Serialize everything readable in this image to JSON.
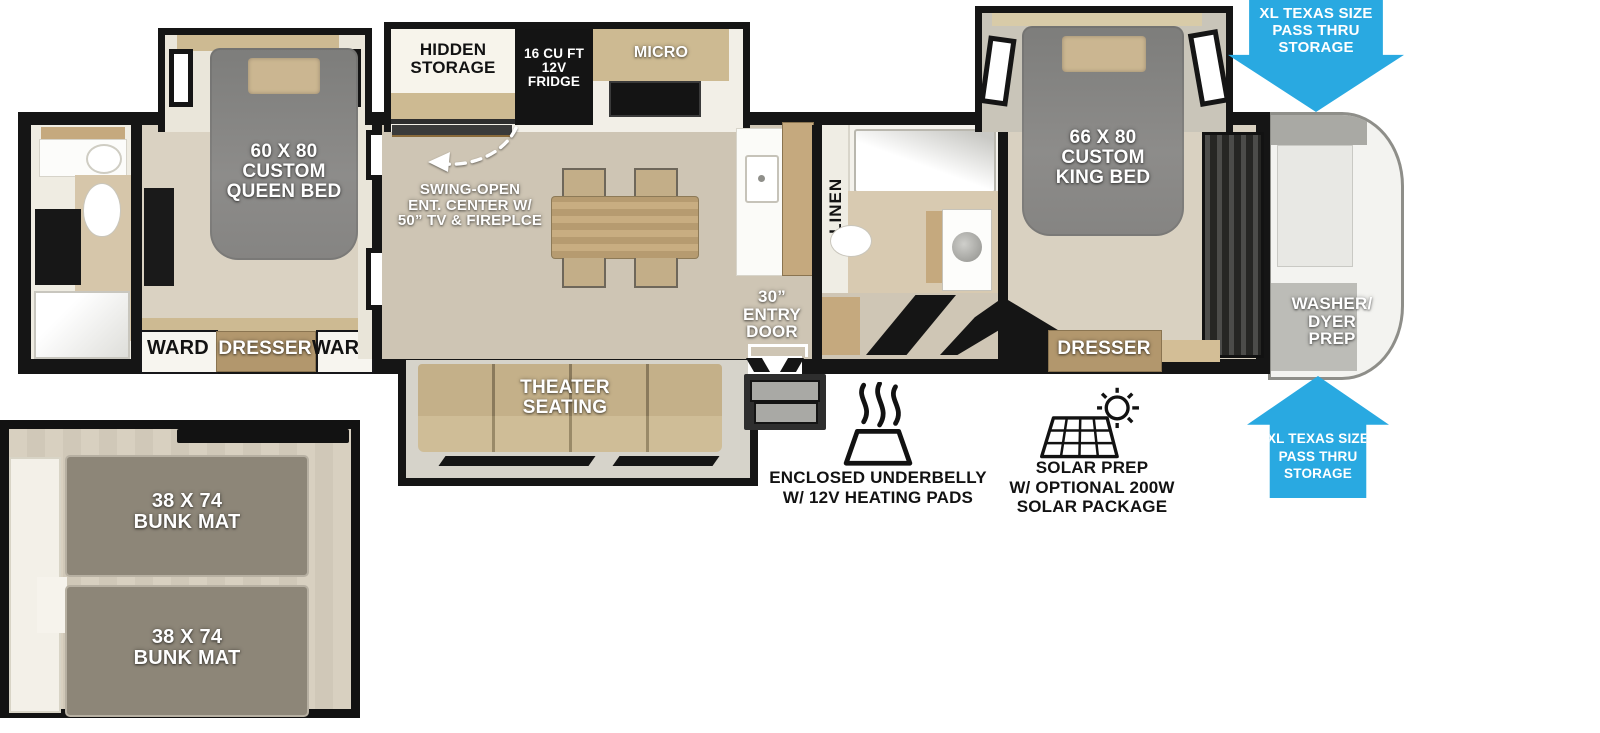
{
  "colors": {
    "arrow_blue": "#29A9E1",
    "wall_black": "#151515",
    "floor_wood": "#d2c9b9",
    "bed_gray": "#868583",
    "cabinet_wood": "#c5a97e",
    "mat_gray": "#8d8678"
  },
  "front_bedroom": {
    "bed": "60 X 80\nCUSTOM\nQUEEN BED",
    "ward_left": "WARD",
    "dresser": "DRESSER",
    "ward_right": "WARD"
  },
  "kitchen": {
    "hidden_storage": "HIDDEN\nSTORAGE",
    "fridge": "16 CU FT\n12V\nFRIDGE",
    "micro": "MICRO",
    "ent_center": "SWING-OPEN\nENT. CENTER W/\n50” TV & FIREPLCE"
  },
  "living": {
    "theater_seating": "THEATER\nSEATING",
    "entry_door": "30”\nENTRY\nDOOR"
  },
  "mid_bathroom": {
    "linen": "LINEN"
  },
  "rear_bedroom": {
    "bed": "66 X 80\nCUSTOM\nKING BED",
    "dresser": "DRESSER"
  },
  "garage": {
    "washer_prep": "WASHER/\nDYER\nPREP"
  },
  "pass_thru": {
    "top_arrow": "XL TEXAS SIZE\nPASS THRU\nSTORAGE",
    "bottom_arrow": "XL TEXAS SIZE\nPASS THRU\nSTORAGE"
  },
  "features": {
    "underbelly": "ENCLOSED UNDERBELLY\nW/ 12V HEATING PADS",
    "solar": "SOLAR PREP\nW/ OPTIONAL 200W\nSOLAR PACKAGE"
  },
  "bunk_room": {
    "bunk_top": "38 X 74\nBUNK MAT",
    "bunk_bottom": "38 X 74\nBUNK MAT"
  }
}
